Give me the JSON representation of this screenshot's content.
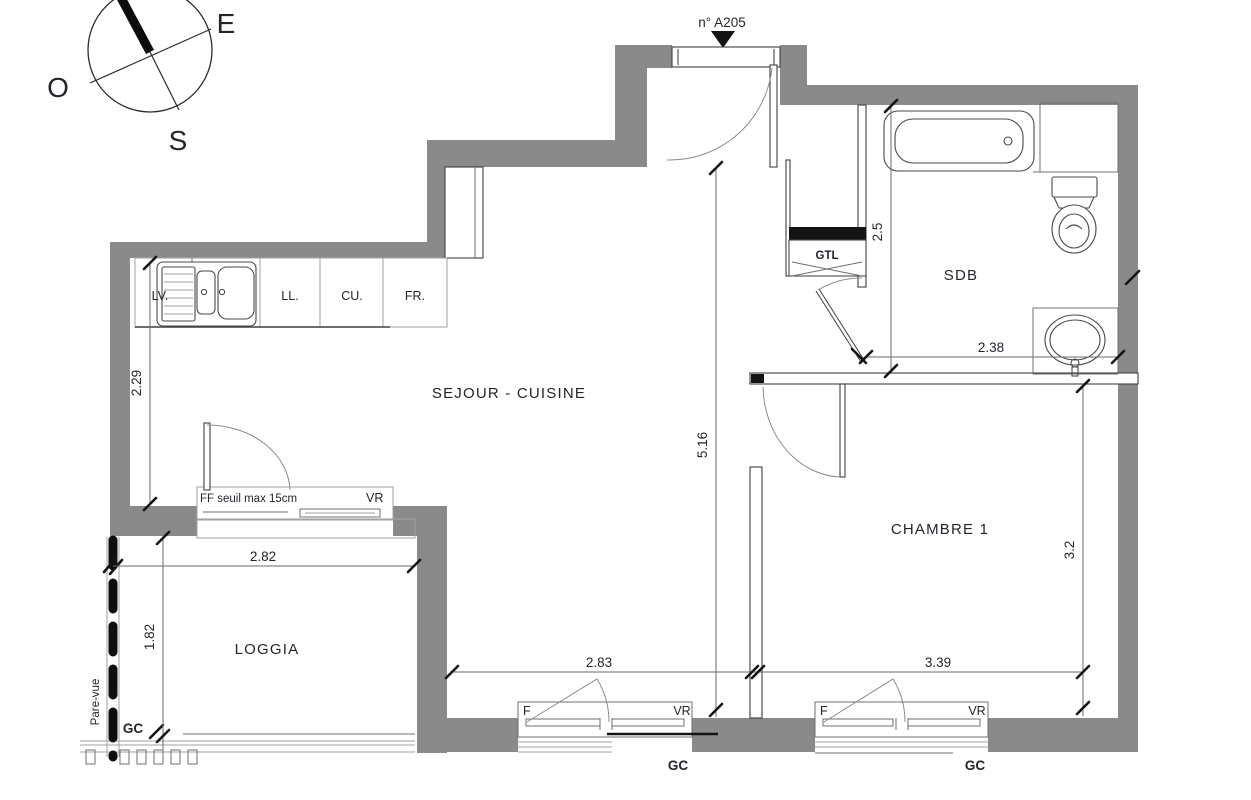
{
  "marker": {
    "unit": "n° A205"
  },
  "compass": {
    "east": "E",
    "west": "O",
    "south": "S"
  },
  "rooms": {
    "sejour": "SEJOUR - CUISINE",
    "sdb": "SDB",
    "chambre": "CHAMBRE 1",
    "loggia": "LOGGIA"
  },
  "kitchen": {
    "lv": "LV.",
    "ll": "LL.",
    "cu": "CU.",
    "fr": "FR."
  },
  "labels": {
    "gtl": "GTL",
    "ff_seuil": "FF seuil max 15cm",
    "vr": "VR",
    "f": "F",
    "gc": "GC",
    "pare_vue": "Pare-vue"
  },
  "dims": {
    "kitchen_depth": "2.29",
    "loggia_width": "2.82",
    "loggia_depth": "1.82",
    "hall_length": "5.16",
    "sdb_depth": "2.5",
    "sdb_width": "2.38",
    "sejour_window": "2.83",
    "chambre_width": "3.39",
    "chambre_depth": "3.2"
  },
  "colors": {
    "wall": "#8a8a8a"
  }
}
